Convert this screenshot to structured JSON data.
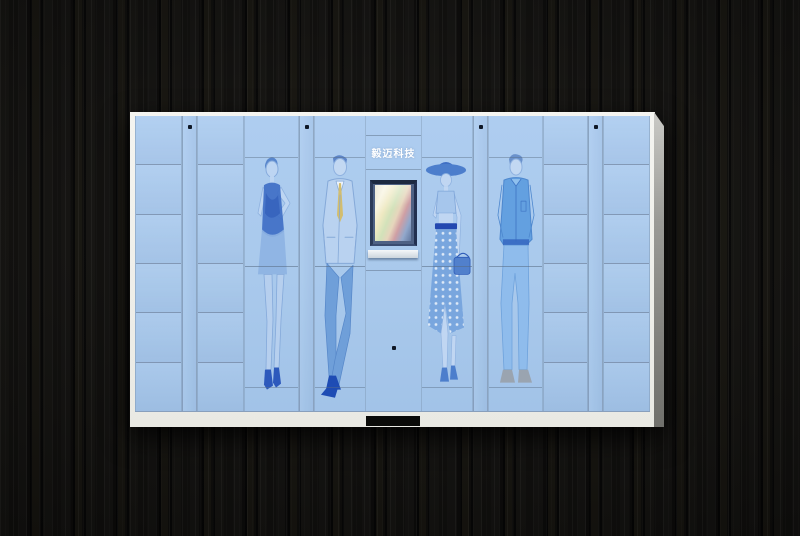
{
  "scene": {
    "type": "product-photo",
    "subject": "smart parcel locker cabinet with fashion illustrations on the doors",
    "background": {
      "material": "dark wood planks, vertical",
      "color": "#0c0b09"
    }
  },
  "cabinet": {
    "colors": {
      "door_blue": "#a9c9ec",
      "frame_white": "#f2f2ee",
      "divider_gray": "#5c6e86",
      "side_panel_gray": "#8f8f8b",
      "artwork_blue": "#4a7fd0",
      "tie_yellow": "#d2bc6a",
      "lock_dot": "#0e1726",
      "screen_bezel": "#1c2940"
    },
    "kiosk": {
      "logo_text": "毅迈科技",
      "screen_state": "on",
      "has_pickup_slot": true
    },
    "columns": [
      {
        "type": "lockers",
        "rows": 6,
        "width": 47
      },
      {
        "type": "lock-strip",
        "width": 15
      },
      {
        "type": "lockers",
        "rows": 6,
        "width": 47
      },
      {
        "type": "figure",
        "figure": "woman-dress",
        "width": 55
      },
      {
        "type": "lock-strip",
        "width": 15
      },
      {
        "type": "figure",
        "figure": "man-suit",
        "width": 52
      },
      {
        "type": "kiosk",
        "width": 55
      },
      {
        "type": "figure",
        "figure": "woman-hat",
        "width": 52
      },
      {
        "type": "lock-strip",
        "width": 15
      },
      {
        "type": "figure",
        "figure": "man-casual",
        "width": 55
      },
      {
        "type": "lockers",
        "rows": 6,
        "width": 45
      },
      {
        "type": "lock-strip",
        "width": 15
      },
      {
        "type": "lockers",
        "rows": 6,
        "width": 47
      }
    ],
    "figures": [
      {
        "id": "woman-dress",
        "description": "woman in sleeveless blue dress, hand on hip, ankle boots"
      },
      {
        "id": "man-suit",
        "description": "man in light blue suit with yellow tie, legs crossed"
      },
      {
        "id": "woman-hat",
        "description": "woman in wide-brim hat, polka-dot skirt, handbag"
      },
      {
        "id": "man-casual",
        "description": "man in casual blue jacket and jeans"
      }
    ]
  }
}
